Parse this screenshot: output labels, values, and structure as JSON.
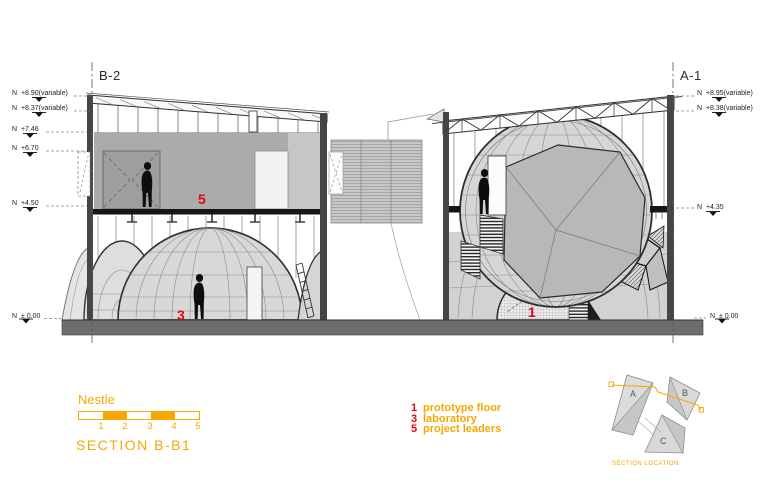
{
  "colors": {
    "orange": "#F6A800",
    "red": "#E30613"
  },
  "grid": {
    "left_label": "B-2",
    "right_label": "A-1"
  },
  "levels": {
    "left": [
      {
        "text": "N  +8.90(variable)"
      },
      {
        "text": "N  +8.37(variable)"
      },
      {
        "text": "N  +7.46"
      },
      {
        "text": "N  +6.70"
      },
      {
        "text": "N  +4.50"
      },
      {
        "text": "N  ± 0.00"
      }
    ],
    "right": [
      {
        "text": "N  +8.95(variable)"
      },
      {
        "text": "N  +8.38(variable)"
      },
      {
        "text": "N  +4.35"
      },
      {
        "text": "N  ± 0.00"
      }
    ]
  },
  "room_tags": {
    "project_leaders": "5",
    "laboratory": "3",
    "prototype_floor": "1"
  },
  "title_block": {
    "client": "Nestle",
    "drawing_title": "SECTION B-B1",
    "scale_ticks": [
      "1",
      "2",
      "3",
      "4",
      "5"
    ]
  },
  "legend": {
    "items": [
      {
        "number": "1",
        "label": "prototype floor"
      },
      {
        "number": "3",
        "label": "laboratory"
      },
      {
        "number": "5",
        "label": "project leaders"
      }
    ]
  },
  "key_plan": {
    "building_labels": [
      "A",
      "B",
      "C"
    ],
    "caption": "SECTION LOCATION"
  }
}
